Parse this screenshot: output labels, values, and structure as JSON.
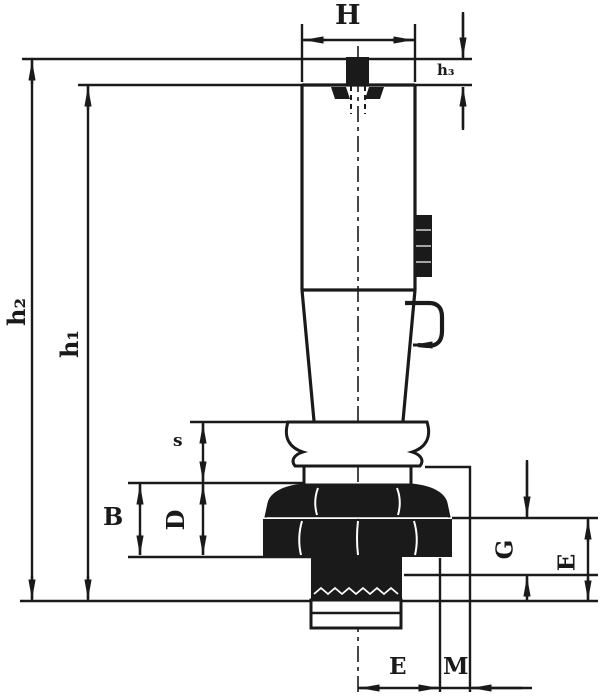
{
  "drawing": {
    "type": "engineering-dimension-drawing",
    "colors": {
      "ink": "#1a1a1a",
      "background": "#ffffff"
    },
    "labels": {
      "H": "H",
      "h3": "h₃",
      "h2": "h₂",
      "h1": "h₁",
      "s": "s",
      "B": "B",
      "D": "D",
      "G": "G",
      "E_side": "E",
      "E_bottom": "E",
      "M_bottom": "M"
    }
  }
}
